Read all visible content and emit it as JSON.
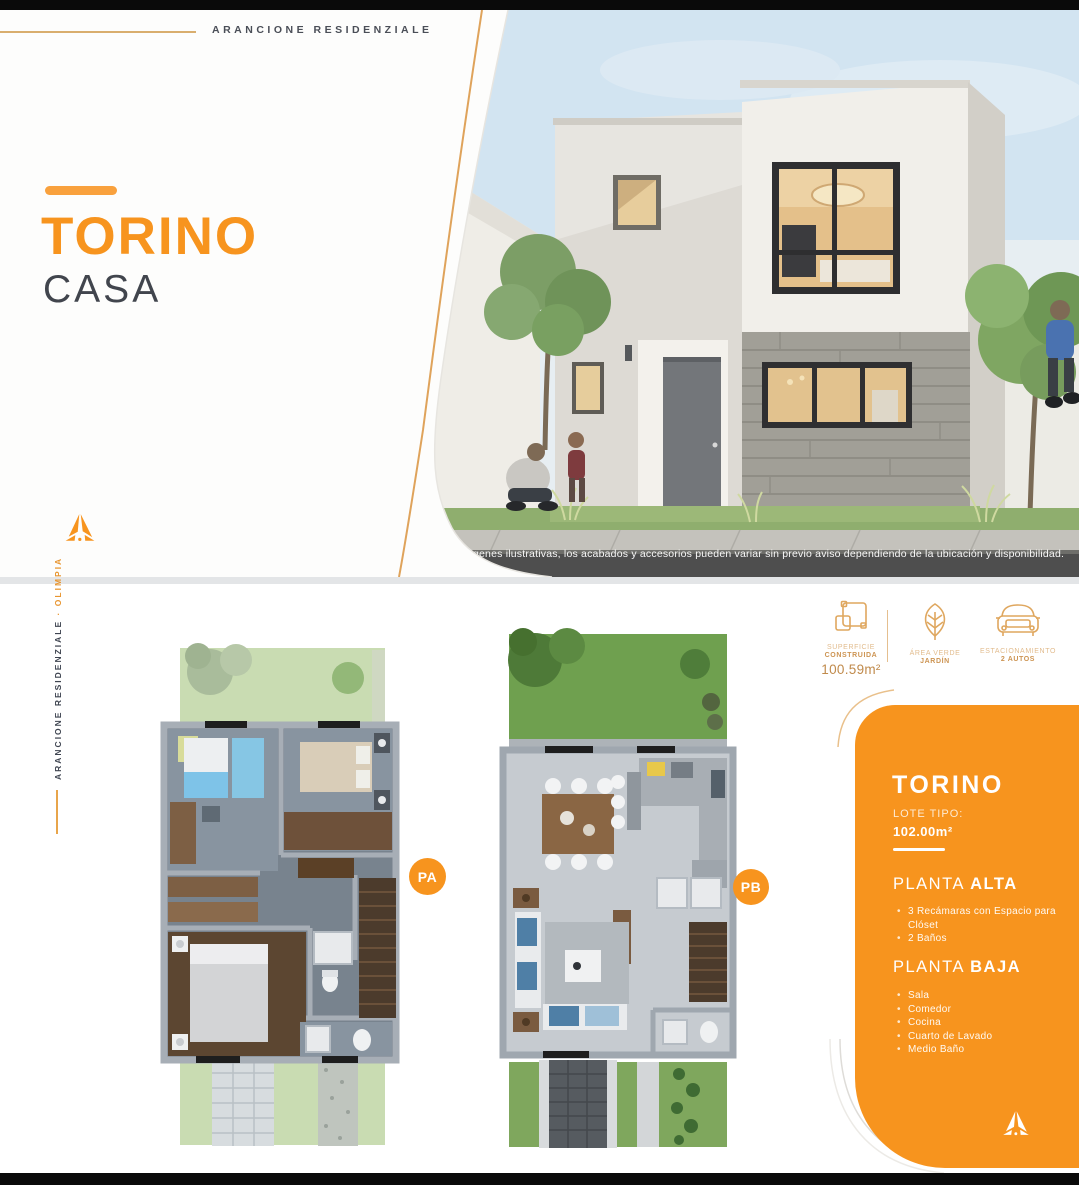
{
  "brand": {
    "name": "ARANCIONE RESIDENZIALE",
    "separator": "·",
    "project": "OLIMPIA"
  },
  "hero": {
    "title": "TORINO",
    "subtitle": "CASA",
    "photo_caption": "Imágenes ilustrativas, los acabados y accesorios pueden variar sin previo aviso dependiendo de la ubicación y disponibilidad."
  },
  "plans": {
    "pa_badge": "PA",
    "pb_badge": "PB"
  },
  "features": {
    "surface": {
      "line1": "SUPERFICIE",
      "line2": "CONSTRUIDA",
      "value": "100.59m²"
    },
    "garden": {
      "line1": "ÁREA VERDE",
      "line2": "JARDÍN"
    },
    "parking": {
      "line1": "ESTACIONAMIENTO",
      "line2": "2 AUTOS"
    }
  },
  "info_panel": {
    "title": "TORINO",
    "lot_label": "LOTE TIPO:",
    "lot_value": "102.00m²",
    "planta_alta": {
      "label_regular": "PLANTA ",
      "label_bold": "ALTA",
      "items": [
        "3 Recámaras con Espacio para Clóset",
        "2 Baños"
      ]
    },
    "planta_baja": {
      "label_regular": "PLANTA ",
      "label_bold": "BAJA",
      "items": [
        "Sala",
        "Comedor",
        "Cocina",
        "Cuarto de Lavado",
        "Medio Baño"
      ]
    }
  },
  "colors": {
    "accent": "#F7941E",
    "accent_light": "#E8A54B",
    "dark_text": "#41454D"
  }
}
